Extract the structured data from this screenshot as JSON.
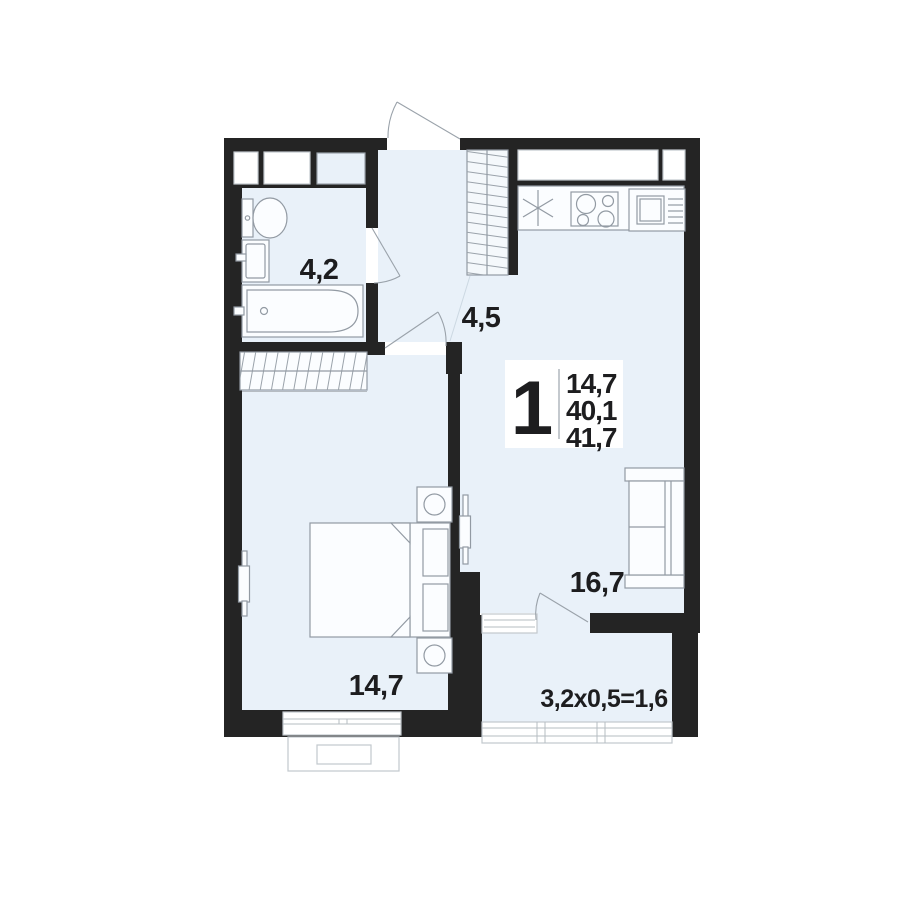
{
  "title": "1-room apartment floor plan",
  "legend": {
    "rooms_count": "1",
    "living_area": "14,7",
    "area_no_balcony": "40,1",
    "total_area": "41,7"
  },
  "rooms": {
    "bathroom": {
      "label": "4,2"
    },
    "hallway": {
      "label": "4,5"
    },
    "living_room": {
      "label": "16,7"
    },
    "bedroom": {
      "label": "14,7"
    },
    "balcony": {
      "label": "3,2x0,5=1,6"
    }
  },
  "icons": {
    "kitchen_sink": "asterisk-burst",
    "stove": "four-burner-circles",
    "fridge": "square-with-shelf-lines",
    "wardrobe": "diagonal-hatch",
    "door": "quarter-arc-swing",
    "tv": "thin-wall-rectangle"
  },
  "colors": {
    "wall": "#242424",
    "floor": "#e9f1f9",
    "furniture_stroke": "#929aa3",
    "text": "#1d1d1f",
    "background": "#ffffff"
  }
}
